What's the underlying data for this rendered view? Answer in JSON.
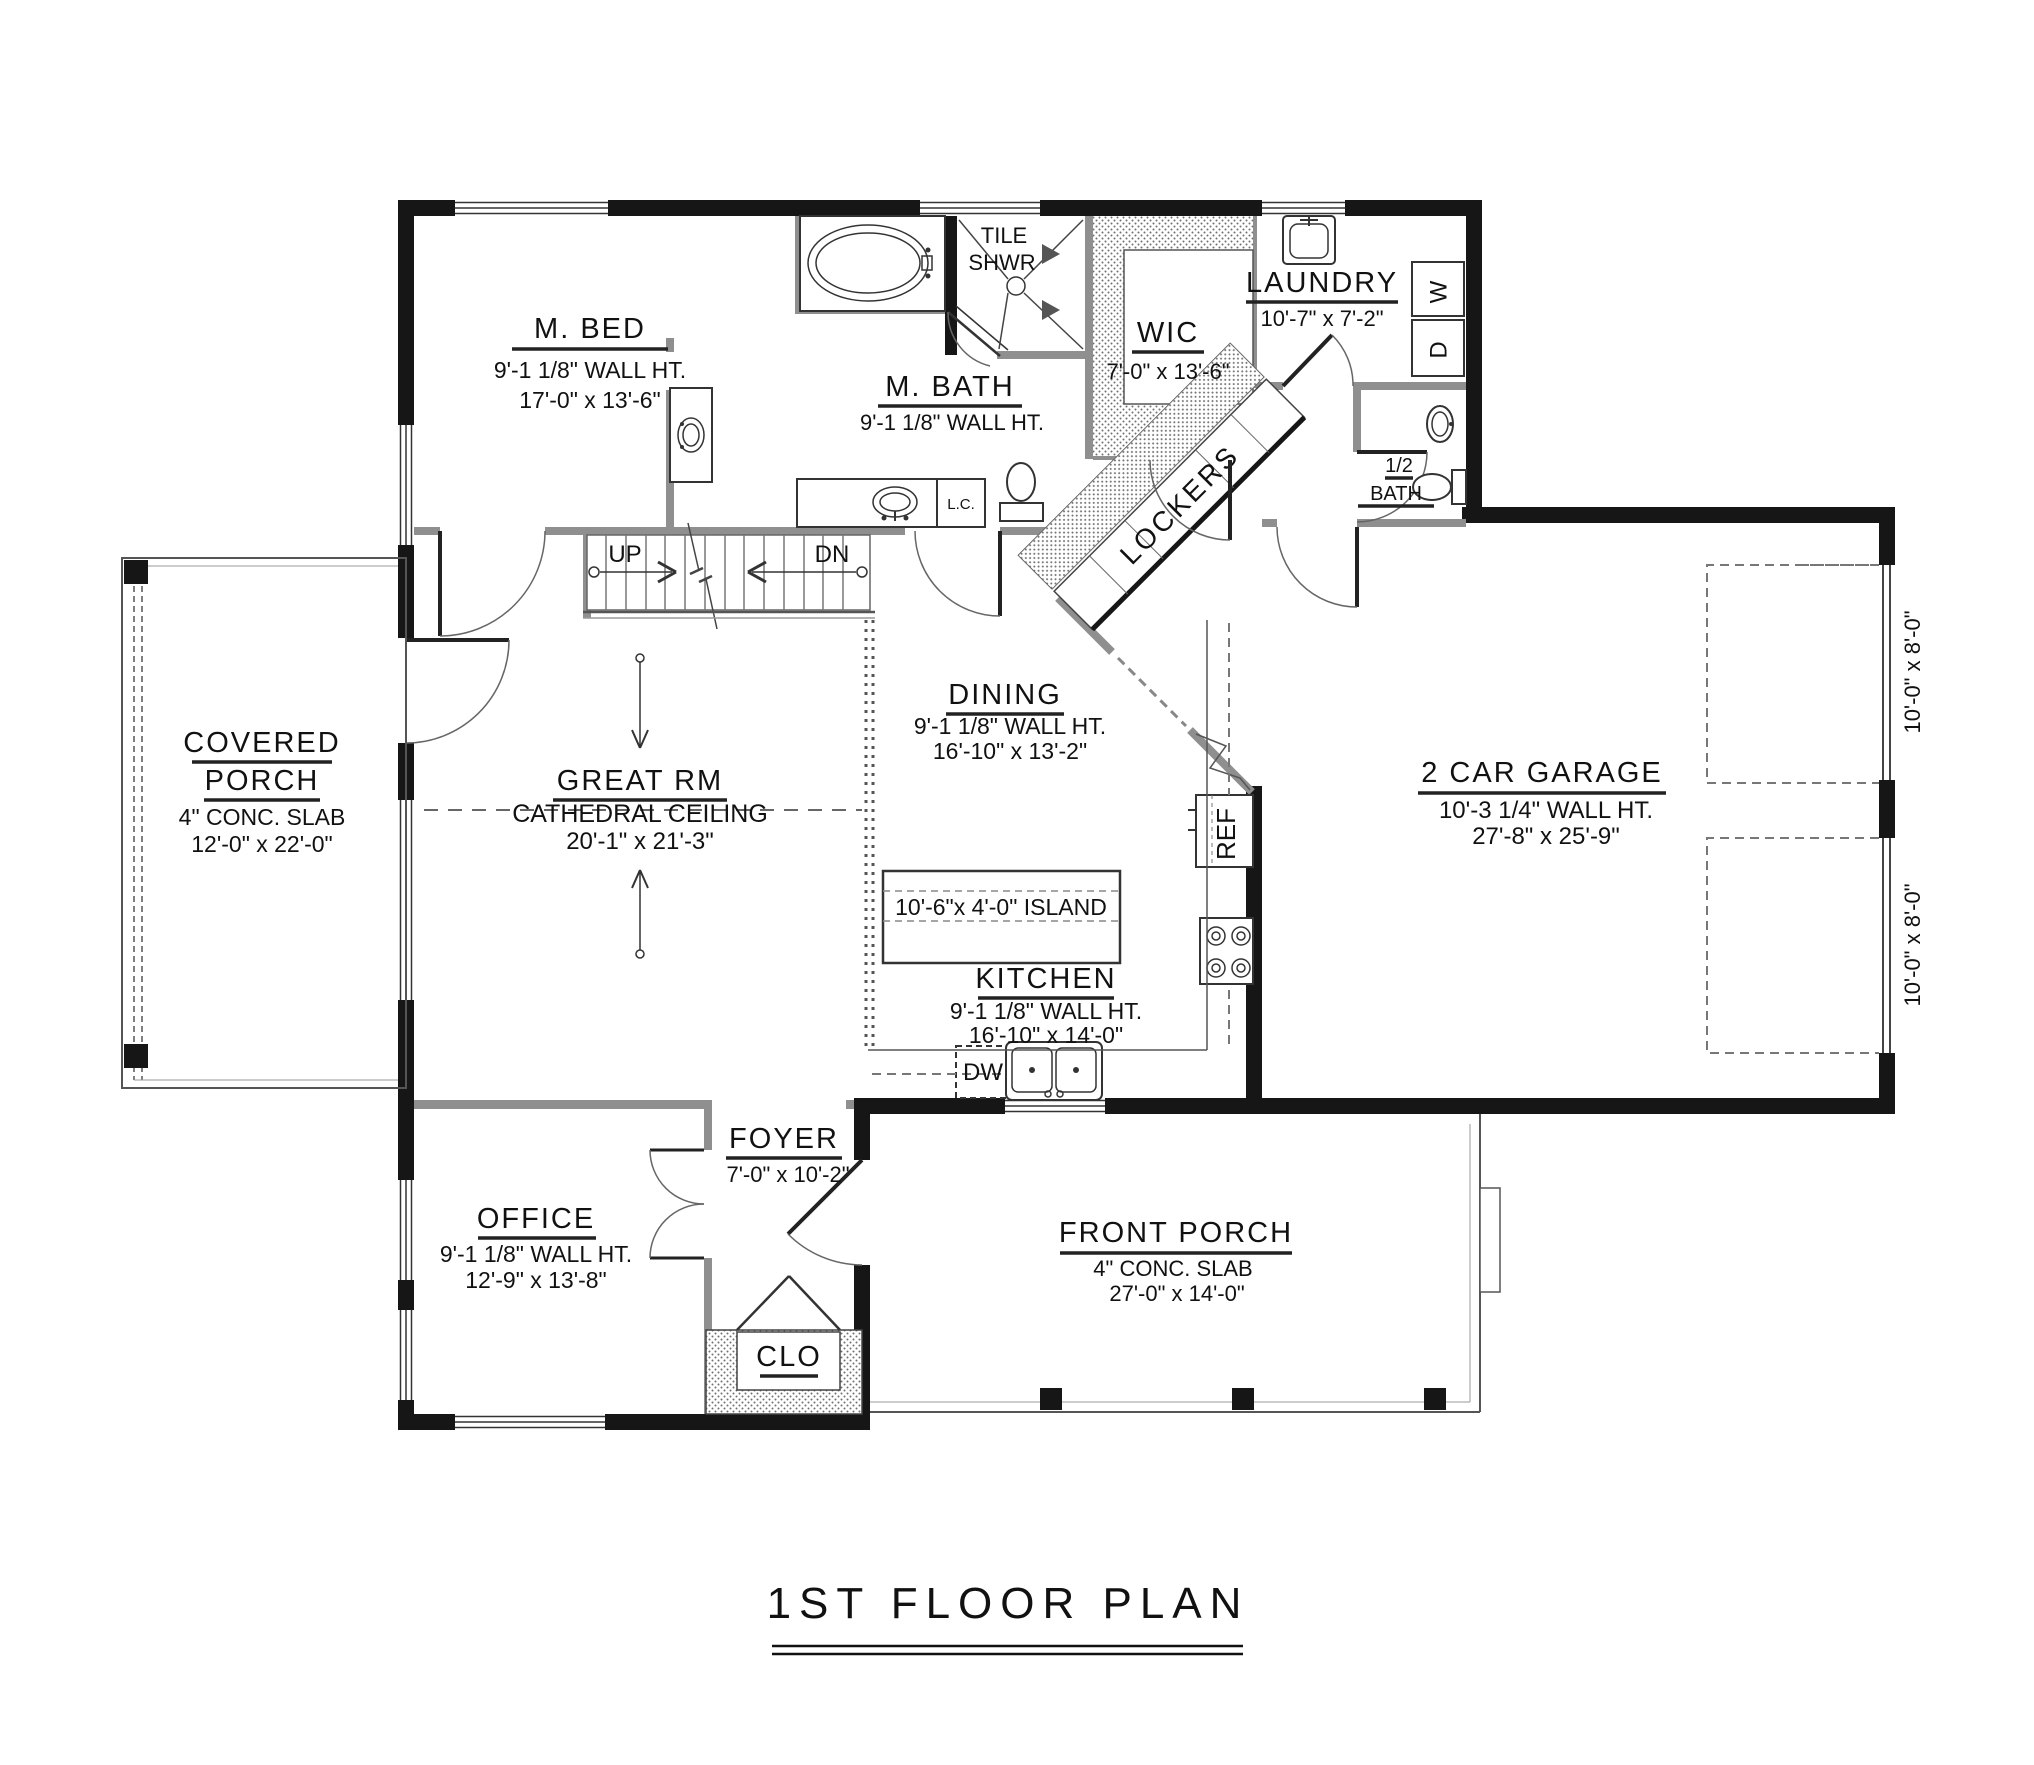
{
  "title": {
    "text": "1ST FLOOR PLAN"
  },
  "rooms": {
    "m_bed": {
      "name": "M. BED",
      "wall_ht": "9'-1 1/8\" WALL HT.",
      "size": "17'-0\" x 13'-6\""
    },
    "tile_shwr": {
      "line1": "TILE",
      "line2": "SHWR"
    },
    "m_bath": {
      "name": "M. BATH",
      "wall_ht": "9'-1 1/8\" WALL HT."
    },
    "wic": {
      "name": "WIC",
      "size": "7'-0\" x 13'-6\""
    },
    "laundry": {
      "name": "LAUNDRY",
      "size": "10'-7\" x 7'-2\""
    },
    "half_bath": {
      "line1": "1/2",
      "line2": "BATH"
    },
    "lockers": {
      "name": "LOCKERS"
    },
    "covered_porch": {
      "name1": "COVERED",
      "name2": "PORCH",
      "slab": "4\" CONC. SLAB",
      "size": "12'-0\" x 22'-0\""
    },
    "great_rm": {
      "name": "GREAT RM",
      "ceiling": "CATHEDRAL CEILING",
      "size": "20'-1\" x 21'-3\""
    },
    "dining": {
      "name": "DINING",
      "wall_ht": "9'-1 1/8\" WALL HT.",
      "size": "16'-10\" x 13'-2\""
    },
    "kitchen": {
      "name": "KITCHEN",
      "wall_ht": "9'-1 1/8\" WALL HT.",
      "size": "16'-10\" x 14'-0\""
    },
    "island": {
      "label": "10'-6\"x 4'-0\" ISLAND"
    },
    "garage": {
      "name": "2 CAR GARAGE",
      "wall_ht": "10'-3 1/4\" WALL HT.",
      "size": "27'-8\" x 25'-9\""
    },
    "foyer": {
      "name": "FOYER",
      "size": "7'-0\" x 10'-2\""
    },
    "office": {
      "name": "OFFICE",
      "wall_ht": "9'-1 1/8\" WALL HT.",
      "size": "12'-9\" x 13'-8\""
    },
    "front_porch": {
      "name": "FRONT PORCH",
      "slab": "4\" CONC. SLAB",
      "size": "27'-0\" x 14'-0\""
    },
    "clo": {
      "name": "CLO"
    }
  },
  "annotations": {
    "up": "UP",
    "dn": "DN",
    "ref": "REF",
    "dw": "DW",
    "lc": "L.C.",
    "washer": "W",
    "dryer": "D",
    "garage_door_1": "10'-0\" x 8'-0\"",
    "garage_door_2": "10'-0\" x 8'-0\""
  },
  "colors": {
    "wall": "#161616",
    "interior_wall": "#8f8f8f",
    "line": "#555555",
    "background": "#ffffff"
  }
}
